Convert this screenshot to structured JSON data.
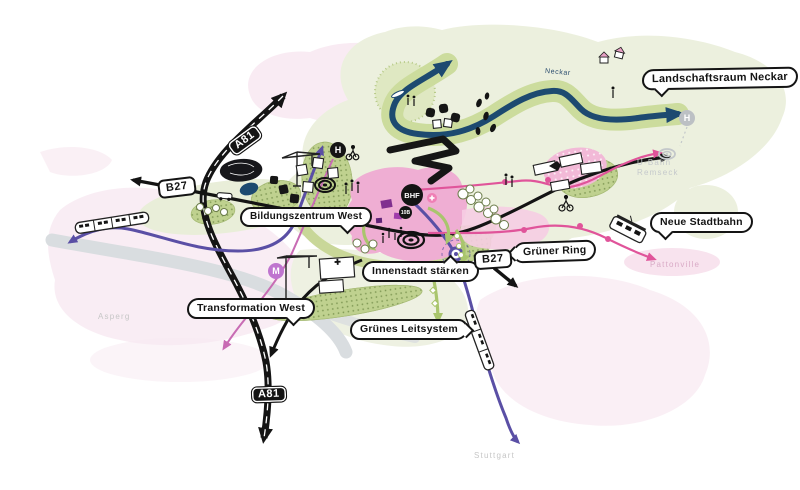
{
  "callouts": [
    {
      "id": "landschaftsraum-neckar",
      "label": "Landschaftsraum Neckar"
    },
    {
      "id": "bildungszentrum-west",
      "label": "Bildungszentrum West"
    },
    {
      "id": "neue-stadtbahn",
      "label": "Neue Stadtbahn"
    },
    {
      "id": "gruener-ring",
      "label": "Grüner Ring"
    },
    {
      "id": "innenstadt-staerken",
      "label": "Innenstadt stärken"
    },
    {
      "id": "transformation-west",
      "label": "Transformation West"
    },
    {
      "id": "gruenes-leitsystem",
      "label": "Grünes Leitsystem"
    }
  ],
  "road_badges": {
    "a81_north": "A81",
    "b27_west": "B27",
    "b27_center": "B27",
    "a81_south": "A81"
  },
  "transit_nodes": {
    "bhf": "BHF",
    "line_10b": "10B",
    "stop_h_west": "H",
    "stop_h_east": "H",
    "stop_m": "M",
    "plus": "+"
  },
  "place_labels": {
    "asperg": "Asperg",
    "stuttgart": "Stuttgart",
    "pattonville": "Pattonville",
    "ubahn_line1": "U-Bahn",
    "ubahn_line2": "Remseck",
    "neckar": "Neckar"
  },
  "colors": {
    "river_navy": "#1d4a70",
    "sbahn_purple": "#5a4fa5",
    "stadtbahn_pink": "#e0549a",
    "landscape_green": "#ccdc9d",
    "city_pink": "#efaed3",
    "road_black": "#141414"
  }
}
